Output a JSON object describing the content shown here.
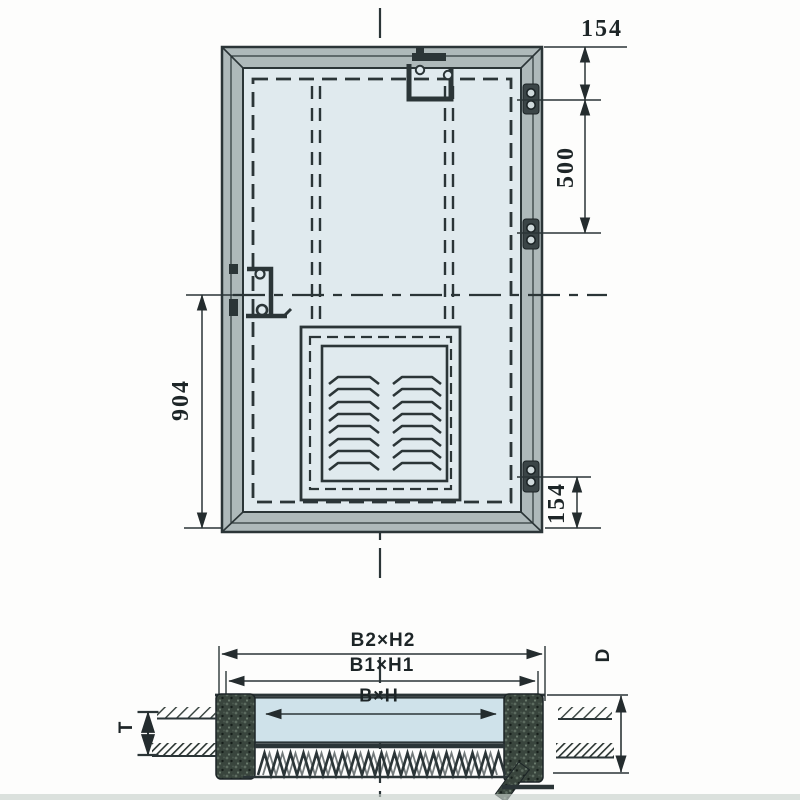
{
  "front_view": {
    "dim_top_right": "154",
    "dim_right": "500",
    "dim_left": "904",
    "dim_bottom_right": "154"
  },
  "section_view": {
    "dim_outer": "B2×H2",
    "dim_mid": "B1×H1",
    "dim_opening": "B×H",
    "dim_depth": "D",
    "dim_thickness": "T"
  },
  "colors": {
    "line": "#2b3537",
    "frame": "#aeb9ba",
    "panel": "#e0eaee",
    "glass": "#cfe2ea",
    "gasket": "#39453d"
  }
}
